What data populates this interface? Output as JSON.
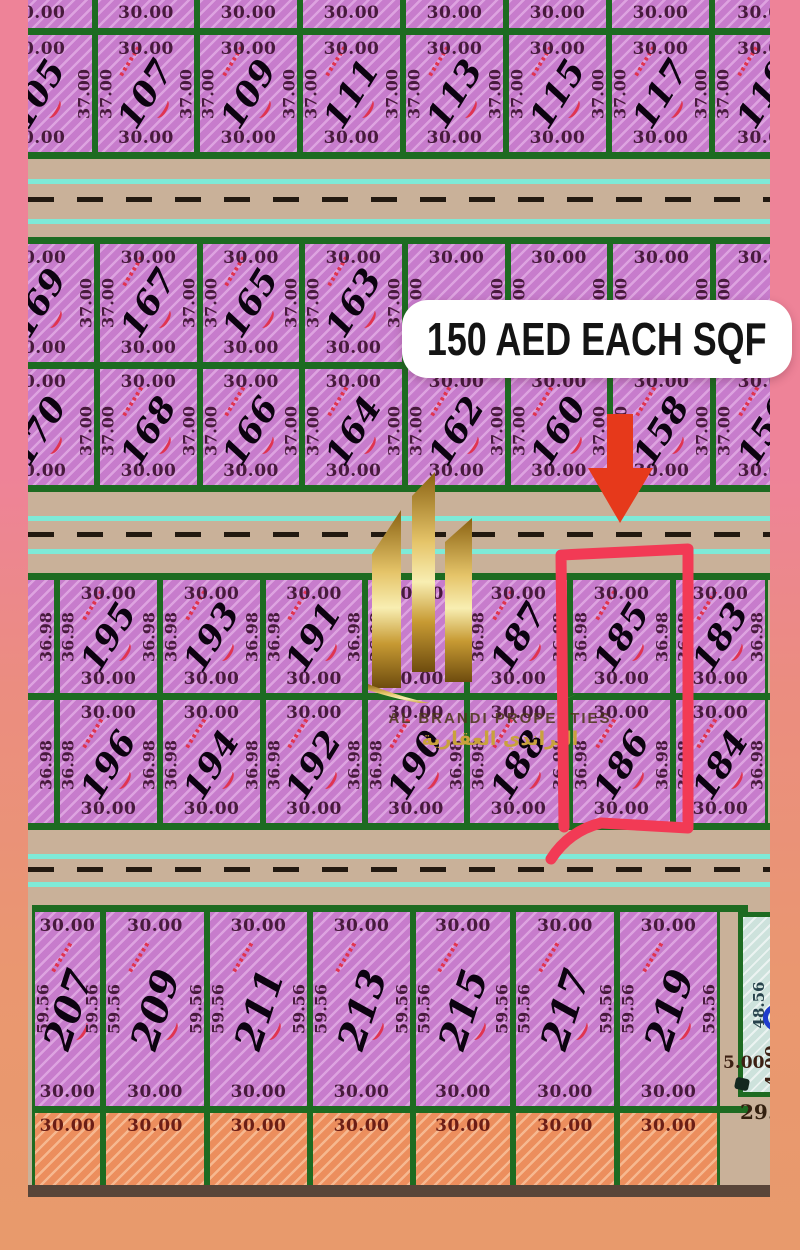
{
  "price_banner": {
    "text": "150 AED EACH SQF"
  },
  "watermark": {
    "line1": "AL BRANDI PROPERTIES",
    "line2": "البراندي العقارية"
  },
  "map": {
    "corner_plot": {
      "depth": "48.56",
      "front": "5.00",
      "side": "4.00"
    },
    "corner_road_label": "29.",
    "roads": [
      {
        "top": 159,
        "h": 78,
        "cyan": [
          20,
          60
        ],
        "dash": 38
      },
      {
        "top": 492,
        "h": 81,
        "cyan": [
          24,
          57
        ],
        "dash": 40
      },
      {
        "top": 830,
        "h": 75,
        "cyan": [
          24,
          52
        ],
        "dash": 37
      }
    ],
    "blocks": [
      {
        "name": "cut-row-top",
        "top": 0,
        "h": 28,
        "fill": "pink",
        "dim": "30.00",
        "noB": true,
        "cols": [
          {
            "x": -48,
            "w": 115
          },
          {
            "x": 67,
            "w": 102
          },
          {
            "x": 169,
            "w": 103
          },
          {
            "x": 272,
            "w": 103
          },
          {
            "x": 375,
            "w": 103
          },
          {
            "x": 478,
            "w": 103
          },
          {
            "x": 581,
            "w": 103
          },
          {
            "x": 684,
            "w": 106
          }
        ]
      },
      {
        "name": "row-105-119",
        "top": 28,
        "h": 131,
        "bt": true,
        "bb": true,
        "fill": "pink",
        "dim": "30.00",
        "side": "37.00",
        "ang": -58,
        "cols": [
          {
            "x": -48,
            "w": 115,
            "n": "105"
          },
          {
            "x": 67,
            "w": 102,
            "n": "107"
          },
          {
            "x": 169,
            "w": 103,
            "n": "109"
          },
          {
            "x": 272,
            "w": 103,
            "n": "111"
          },
          {
            "x": 375,
            "w": 103,
            "n": "113"
          },
          {
            "x": 478,
            "w": 103,
            "n": "115"
          },
          {
            "x": 581,
            "w": 103,
            "n": "117"
          },
          {
            "x": 684,
            "w": 106,
            "n": "119"
          }
        ]
      },
      {
        "name": "row-169-163",
        "top": 237,
        "h": 132,
        "bt": true,
        "bb": true,
        "fill": "pink",
        "dim": "30.00",
        "side": "37.00",
        "ang": -58,
        "cols": [
          {
            "x": -48,
            "w": 117,
            "n": "169"
          },
          {
            "x": 69,
            "w": 103,
            "n": "167"
          },
          {
            "x": 172,
            "w": 102,
            "n": "165"
          },
          {
            "x": 274,
            "w": 103,
            "n": "163"
          },
          {
            "x": 377,
            "w": 103
          },
          {
            "x": 480,
            "w": 102
          },
          {
            "x": 582,
            "w": 103
          },
          {
            "x": 685,
            "w": 105
          }
        ]
      },
      {
        "name": "row-170-156",
        "top": 369,
        "h": 123,
        "bb": true,
        "fill": "pink",
        "dim": "30.00",
        "side": "37.00",
        "ang": -58,
        "cols": [
          {
            "x": -48,
            "w": 117,
            "n": "170"
          },
          {
            "x": 69,
            "w": 103,
            "n": "168"
          },
          {
            "x": 172,
            "w": 102,
            "n": "166"
          },
          {
            "x": 274,
            "w": 103,
            "n": "164"
          },
          {
            "x": 377,
            "w": 103,
            "n": "162"
          },
          {
            "x": 480,
            "w": 102,
            "n": "160"
          },
          {
            "x": 582,
            "w": 103,
            "n": "158"
          },
          {
            "x": 685,
            "w": 105,
            "n": "156"
          }
        ]
      },
      {
        "name": "row-195-183",
        "top": 573,
        "h": 127,
        "bt": true,
        "bb": true,
        "fill": "pink",
        "dim": "30.00",
        "side": "36.98",
        "ang": -58,
        "cols": [
          {
            "x": -30,
            "w": 59,
            "t": "",
            "b2": ""
          },
          {
            "x": 29,
            "w": 103,
            "n": "195"
          },
          {
            "x": 132,
            "w": 103,
            "n": "193"
          },
          {
            "x": 235,
            "w": 102,
            "n": "191"
          },
          {
            "x": 337,
            "w": 102
          },
          {
            "x": 439,
            "w": 103,
            "n": "187"
          },
          {
            "x": 542,
            "w": 103,
            "n": "185"
          },
          {
            "x": 645,
            "w": 95,
            "n": "183"
          }
        ]
      },
      {
        "name": "row-196-184",
        "top": 700,
        "h": 130,
        "bb": true,
        "fill": "pink",
        "dim": "30.00",
        "side": "36.98",
        "ang": -58,
        "cols": [
          {
            "x": -30,
            "w": 59,
            "t": "",
            "b2": ""
          },
          {
            "x": 29,
            "w": 103,
            "n": "196"
          },
          {
            "x": 132,
            "w": 103,
            "n": "194"
          },
          {
            "x": 235,
            "w": 102,
            "n": "192"
          },
          {
            "x": 337,
            "w": 102,
            "n": "190"
          },
          {
            "x": 439,
            "w": 103,
            "n": "188"
          },
          {
            "x": 542,
            "w": 103,
            "n": "186"
          },
          {
            "x": 645,
            "w": 95,
            "n": "184"
          }
        ]
      },
      {
        "name": "row-207-219",
        "top": 905,
        "h": 208,
        "bt": true,
        "bb": true,
        "span": [
          4,
          720
        ],
        "fill": "pink",
        "dim": "30.00",
        "side": "59.56",
        "ang": -72,
        "fs": 38,
        "cols": [
          {
            "x": 4,
            "w": 71,
            "n": "207"
          },
          {
            "x": 75,
            "w": 104,
            "n": "209"
          },
          {
            "x": 179,
            "w": 103,
            "n": "211"
          },
          {
            "x": 282,
            "w": 103,
            "n": "213"
          },
          {
            "x": 385,
            "w": 100,
            "n": "215"
          },
          {
            "x": 485,
            "w": 104,
            "n": "217"
          },
          {
            "x": 589,
            "w": 103,
            "n": "219"
          }
        ]
      },
      {
        "name": "cut-row-bottom",
        "top": 1113,
        "h": 72,
        "fill": "orange",
        "dim": "30.00",
        "noB": true,
        "cols": [
          {
            "x": 4,
            "w": 71
          },
          {
            "x": 75,
            "w": 104
          },
          {
            "x": 179,
            "w": 103
          },
          {
            "x": 282,
            "w": 103
          },
          {
            "x": 385,
            "w": 100
          },
          {
            "x": 485,
            "w": 104
          },
          {
            "x": 589,
            "w": 103
          }
        ]
      }
    ]
  },
  "colors": {
    "plot_pink": "#c77ccc",
    "border_green": "#1d6b21",
    "road_tan": "#c9b199",
    "stripe_cyan": "#7eead7",
    "marker_red": "#f23a55",
    "arrow_red": "#e6391b",
    "orange_plot": "#ec8e5d",
    "teal_plot": "#cde2dc",
    "banner_bg": "#ffffff",
    "banner_text": "#141414"
  }
}
